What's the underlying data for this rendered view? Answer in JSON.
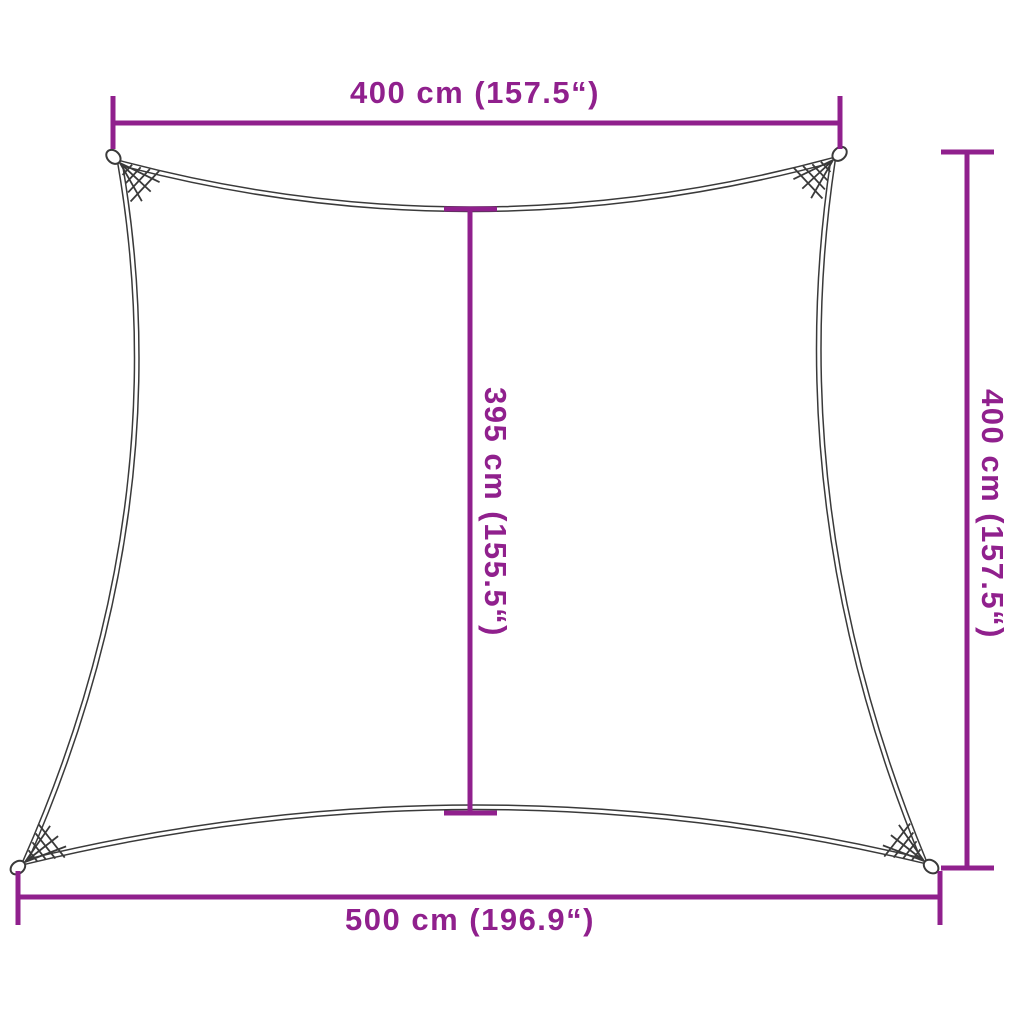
{
  "diagram": {
    "kind": "shade-sail-dimension-diagram",
    "dimensions": {
      "top": {
        "label": "400 cm (157.5“)"
      },
      "right": {
        "label": "400 cm (157.5“)"
      },
      "middle": {
        "label": "395 cm (155.5“)"
      },
      "bottom": {
        "label": "500 cm (196.9“)"
      }
    }
  },
  "colors": {
    "accent": "#90208D",
    "outline": "#3A3A3A",
    "background": "#FFFFFF"
  }
}
